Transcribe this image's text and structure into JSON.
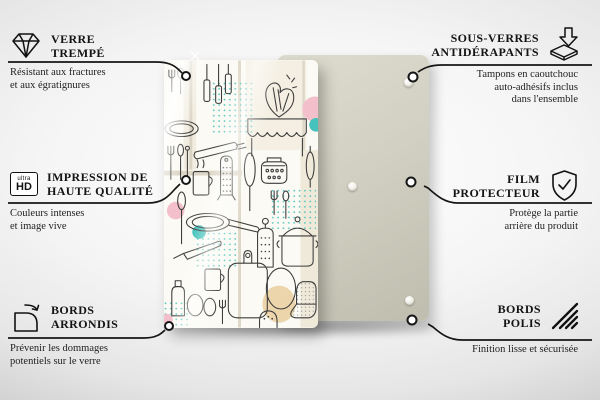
{
  "features": {
    "tempered_glass": {
      "icon": "diamond-icon",
      "title": [
        "VERRE",
        "TREMPÉ"
      ],
      "desc": [
        "Résistant aux fractures",
        "et aux égratignures"
      ]
    },
    "anti_slip": {
      "icon": "rubber-pads-icon",
      "title": [
        "SOUS-VERRES",
        "ANTIDÉRAPANTS"
      ],
      "desc": [
        "Tampons en caoutchouc",
        "auto-adhésifs inclus",
        "dans l'ensemble"
      ]
    },
    "print_quality": {
      "icon": "ultra-hd-icon",
      "icon_text": {
        "top": "ultra",
        "bottom": "HD"
      },
      "title": [
        "IMPRESSION DE",
        "HAUTE QUALITÉ"
      ],
      "desc": [
        "Couleurs intenses",
        "et image vive"
      ]
    },
    "protective_film": {
      "icon": "shield-check-icon",
      "title": [
        "FILM",
        "PROTECTEUR"
      ],
      "desc": [
        "Protège la partie",
        "arrière du produit"
      ]
    },
    "rounded_edges": {
      "icon": "rounded-corner-icon",
      "title": [
        "BORDS",
        "ARRONDIS"
      ],
      "desc": [
        "Prévenir les dommages",
        "potentiels sur le verre"
      ]
    },
    "polished_edges": {
      "icon": "hatched-edge-icon",
      "title": [
        "BORDS",
        "POLIS"
      ],
      "desc": [
        "Finition lisse et sécurisée"
      ]
    }
  },
  "product": {
    "front_board": "glass board with kitchen utensils doodle pattern",
    "back_board": "plain beige rear side with anti-slip pads",
    "visible_pads": 3
  },
  "colors": {
    "back_board": "#d2d0c2",
    "pattern_teal": "#3fbdb7",
    "pattern_pink": "#f3bfca",
    "pattern_beige": "#e7d2ab",
    "line_art": "#3c3c3c",
    "callout_line": "#161616"
  }
}
